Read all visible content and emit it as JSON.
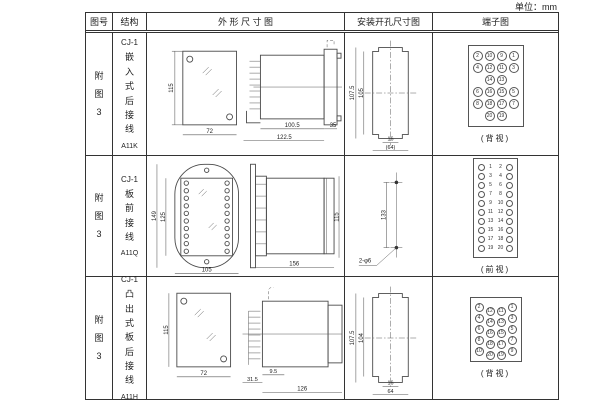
{
  "unit_label": "单位：mm",
  "table": {
    "headers": [
      "图号",
      "结构",
      "外 形 尺 寸 图",
      "安装开孔尺寸图",
      "端子图"
    ]
  },
  "rows": [
    {
      "fig_no": "附图3",
      "model": "CJ-1",
      "structure": "嵌入式后接线",
      "code": "A11K",
      "outline": {
        "front_height": "115",
        "front_width": "72",
        "body_depth": "100.5",
        "total_depth": "122.5",
        "flange_depth": "35"
      },
      "install": {
        "outer_height": "107.5",
        "inner_height": "105",
        "notch_width": "16",
        "cutout_width": "(64)"
      },
      "terminal": {
        "caption": "(背视)",
        "grid": [
          [
            2,
            10,
            9,
            1
          ],
          [
            4,
            12,
            11,
            3
          ],
          [
            null,
            14,
            13,
            null
          ],
          [
            6,
            16,
            15,
            5
          ],
          [
            8,
            18,
            17,
            7
          ],
          [
            null,
            20,
            19,
            null
          ]
        ]
      }
    },
    {
      "fig_no": "附图3",
      "model": "CJ-1",
      "structure": "板前接线",
      "code": "A11Q",
      "outline": {
        "front_height": "149",
        "plate_height": "125",
        "front_width": "105",
        "side_depth": "156",
        "side_height": "115"
      },
      "install": {
        "hole_spacing": "133",
        "hole_spec": "2-φ6"
      },
      "terminal": {
        "caption": "(前视)",
        "grid": [
          [
            1,
            2
          ],
          [
            3,
            4
          ],
          [
            5,
            6
          ],
          [
            7,
            8
          ],
          [
            9,
            10
          ],
          [
            11,
            12
          ],
          [
            13,
            14
          ],
          [
            15,
            16
          ],
          [
            17,
            18
          ],
          [
            19,
            20
          ]
        ]
      }
    },
    {
      "fig_no": "附图3",
      "model": "CJ-1",
      "structure": "凸出式板后接线",
      "code": "A11H",
      "outline": {
        "front_height": "115",
        "front_width": "72",
        "terminal_depth": "31.5",
        "gap_depth": "9.5",
        "body_depth": "126"
      },
      "install": {
        "outer_height": "107.5",
        "inner_height": "104",
        "notch_width": "16",
        "cutout_width": "64"
      },
      "terminal": {
        "caption": "(背视)",
        "grid": [
          [
            2,
            12,
            11,
            1
          ],
          [
            4,
            14,
            13,
            3
          ],
          [
            6,
            16,
            15,
            5
          ],
          [
            8,
            18,
            17,
            7
          ],
          [
            10,
            20,
            19,
            9
          ]
        ]
      }
    }
  ]
}
